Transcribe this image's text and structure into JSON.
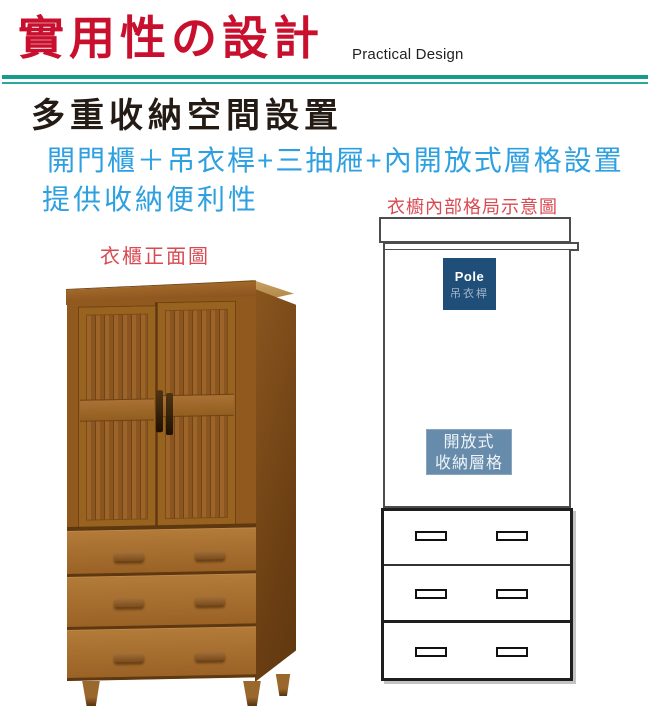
{
  "header": {
    "title": "實用性の設計",
    "subtitle": "Practical Design",
    "title_color": "#c8102e",
    "rule_color": "#169b8f"
  },
  "intro": {
    "heading": "多重收納空間設置",
    "feature_line": "開門櫃＋吊衣桿+三抽屜+內開放式層格設置",
    "benefit_line": "提供收納便利性",
    "feature_color": "#2da0e1"
  },
  "front_view": {
    "caption": "衣櫃正面圖",
    "caption_color": "#d84a52",
    "wood_color": "#9c6428",
    "doors": 2,
    "drawers": 3
  },
  "interior_diagram": {
    "caption": "衣櫥內部格局示意圖",
    "caption_color": "#d84a52",
    "pole_box": {
      "label_en": "Pole",
      "label_zh": "吊衣桿",
      "bg": "#1f4e79"
    },
    "shelf_box": {
      "line1": "開放式",
      "line2": "收納層格",
      "bg": "#678cab"
    },
    "drawers": {
      "count": 3,
      "handles_per_drawer": 2
    }
  }
}
